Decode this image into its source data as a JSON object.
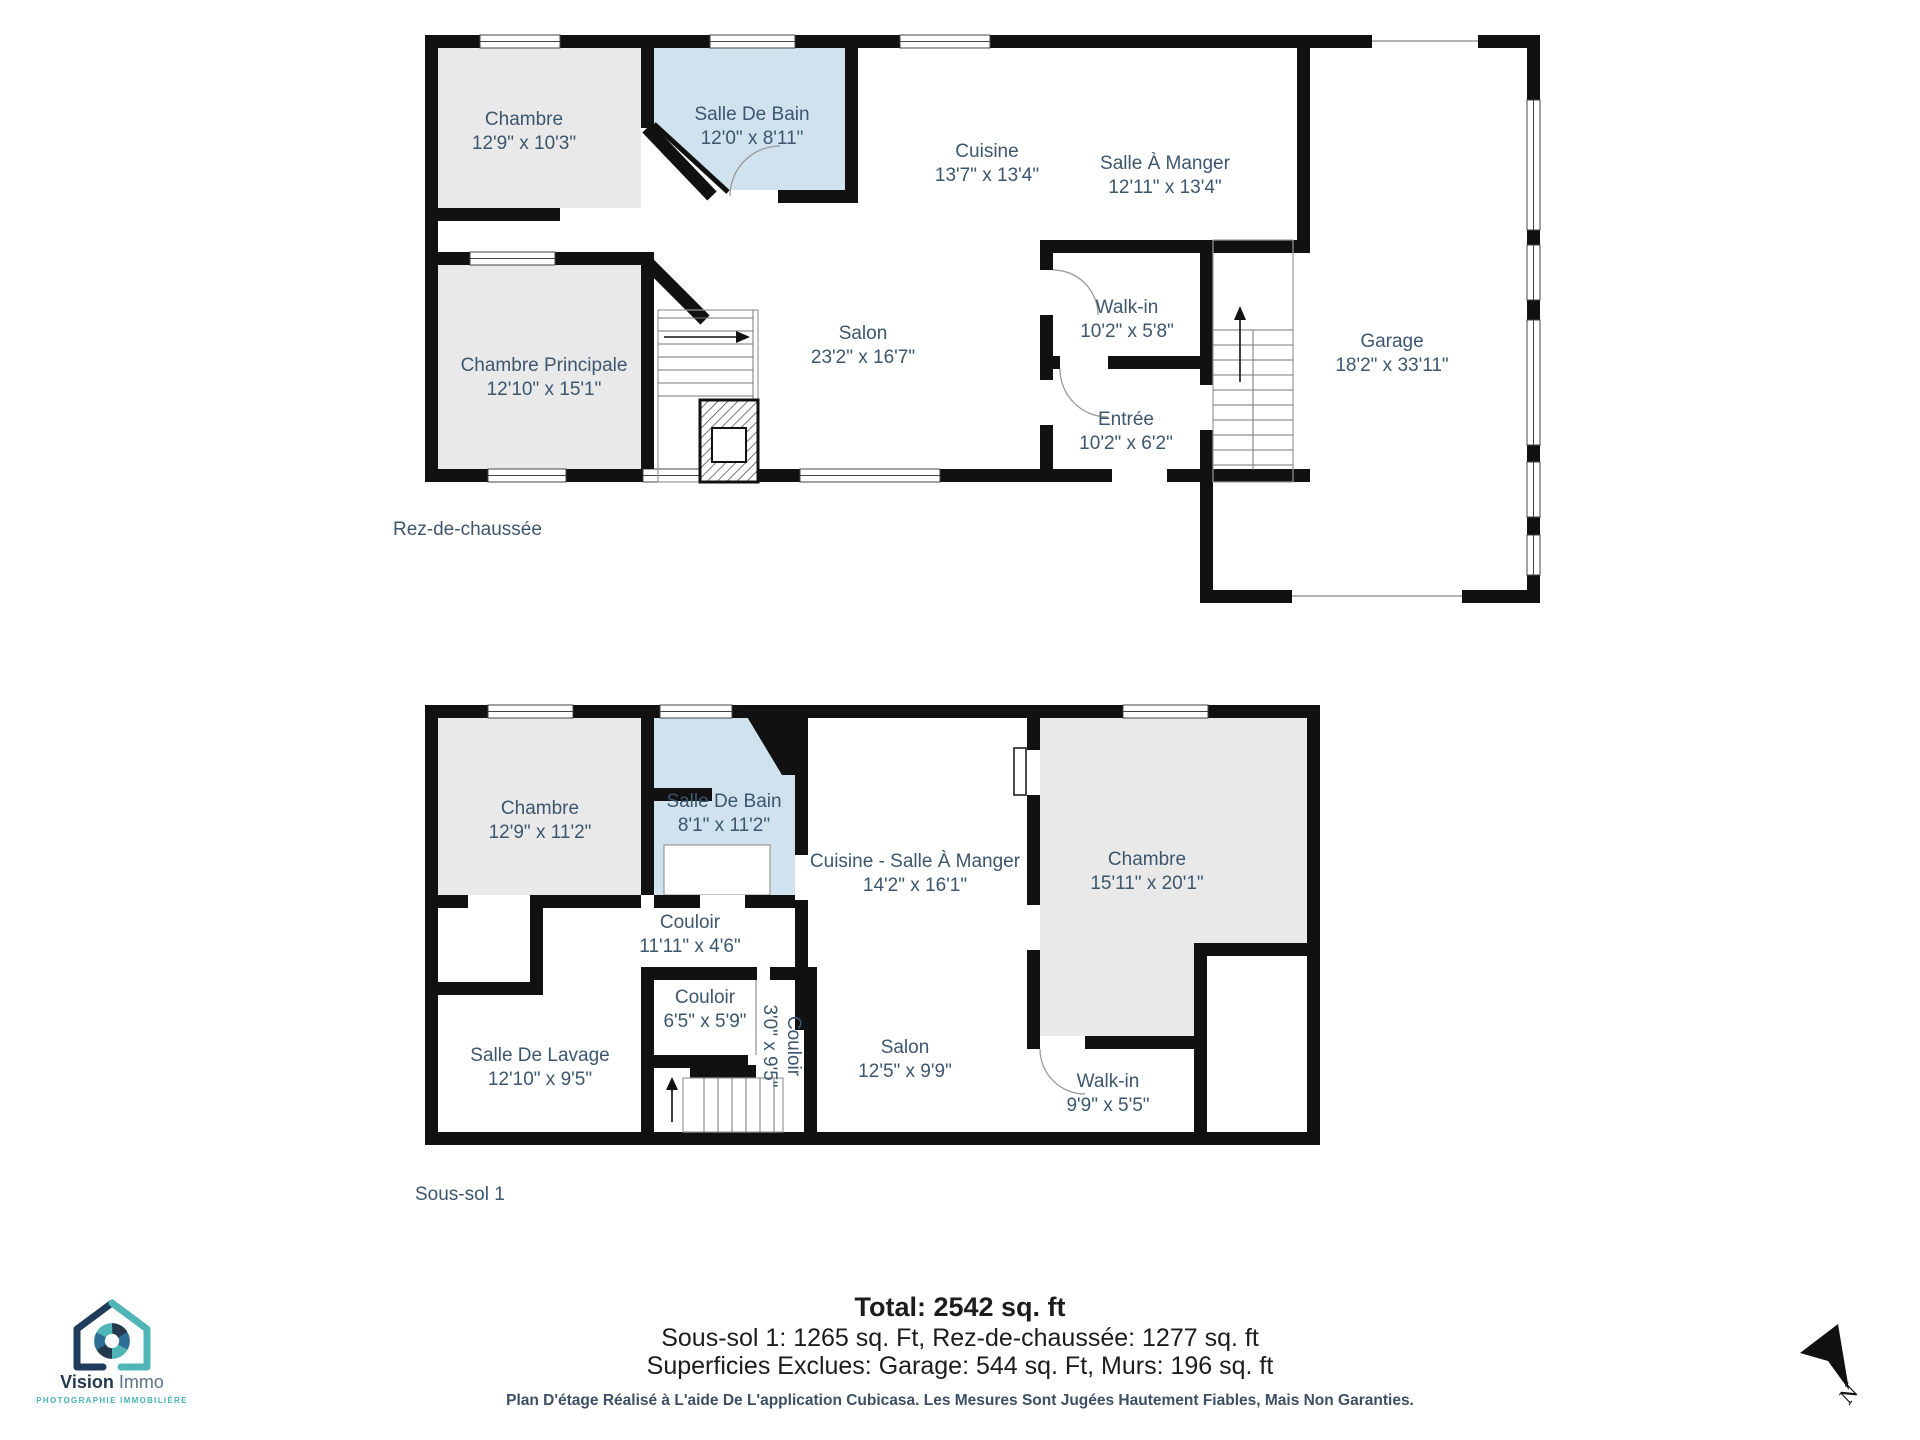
{
  "colors": {
    "wall": "#111111",
    "room_gray": "#e9e9e9",
    "room_blue": "#cfe2ee",
    "label_text": "#3c566e",
    "accent_teal": "#46b2b4",
    "logo_navy": "#24384e"
  },
  "floors": [
    {
      "label": "Rez-de-chaussée",
      "rooms": [
        {
          "name": "Chambre",
          "dims": "12'9\" x 10'3\""
        },
        {
          "name": "Salle De Bain",
          "dims": "12'0\" x 8'11\""
        },
        {
          "name": "Cuisine",
          "dims": "13'7\" x 13'4\""
        },
        {
          "name": "Salle À Manger",
          "dims": "12'11\" x 13'4\""
        },
        {
          "name": "Salon",
          "dims": "23'2\" x 16'7\""
        },
        {
          "name": "Walk-in",
          "dims": "10'2\" x 5'8\""
        },
        {
          "name": "Entrée",
          "dims": "10'2\" x 6'2\""
        },
        {
          "name": "Garage",
          "dims": "18'2\" x 33'11\""
        },
        {
          "name": "Chambre Principale",
          "dims": "12'10\" x 15'1\""
        }
      ]
    },
    {
      "label": "Sous-sol 1",
      "rooms": [
        {
          "name": "Chambre",
          "dims": "12'9\" x 11'2\""
        },
        {
          "name": "Salle De Bain",
          "dims": "8'1\" x 11'2\""
        },
        {
          "name": "Cuisine - Salle À Manger",
          "dims": "14'2\" x 16'1\""
        },
        {
          "name": "Chambre",
          "dims": "15'11\" x 20'1\""
        },
        {
          "name": "Couloir",
          "dims": "11'11\" x 4'6\""
        },
        {
          "name": "Couloir",
          "dims": "6'5\" x 5'9\""
        },
        {
          "name": "Couloir",
          "dims": "3'0\" x 9'5\""
        },
        {
          "name": "Salle De Lavage",
          "dims": "12'10\" x 9'5\""
        },
        {
          "name": "Salon",
          "dims": "12'5\" x 9'9\""
        },
        {
          "name": "Walk-in",
          "dims": "9'9\" x 5'5\""
        }
      ]
    }
  ],
  "summary": {
    "total": "Total: 2542 sq. ft",
    "line2": "Sous-sol 1: 1265 sq. Ft, Rez-de-chaussée: 1277 sq. ft",
    "line3": "Superficies Exclues: Garage: 544 sq. Ft, Murs: 196 sq. ft",
    "disclaimer": "Plan D'étage Réalisé à L'aide De L'application Cubicasa. Les Mesures Sont Jugées Hautement Fiables, Mais Non Garanties."
  },
  "logo": {
    "name_primary": "Vision",
    "name_secondary": " Immo",
    "tagline": "PHOTOGRAPHIE IMMOBILIÈRE"
  },
  "compass": {
    "label": "N"
  }
}
